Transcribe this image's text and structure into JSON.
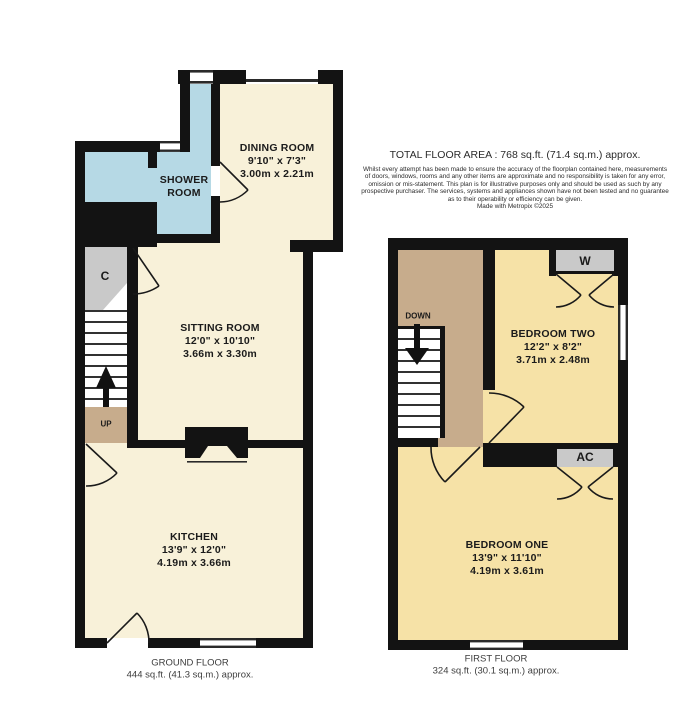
{
  "colors": {
    "wall": "#131313",
    "ground_room": "#f8f1d9",
    "first_room": "#f6e2a7",
    "landing": "#c7ac8c",
    "shower": "#b6d9e5",
    "cupboard": "#c9c9c9",
    "door_line": "#1a1a1a"
  },
  "header": {
    "total_area": "TOTAL FLOOR AREA : 768 sq.ft. (71.4 sq.m.) approx.",
    "disclaimer_lines": [
      "Whilst every attempt has been made to ensure the accuracy of the floorplan contained here, measurements",
      "of doors, windows, rooms and any other items are approximate and no responsibility is taken for any error,",
      "omission or mis-statement. This plan is for illustrative purposes only and should be used as such by any",
      "prospective purchaser. The services, systems and appliances shown have not been tested and no guarantee",
      "as to their operability or efficiency can be given."
    ],
    "made_with": "Made with Metropix ©2025"
  },
  "ground_floor": {
    "title": "GROUND FLOOR",
    "area": "444 sq.ft. (41.3 sq.m.) approx.",
    "rooms": {
      "dining": {
        "name": "DINING ROOM",
        "imperial": "9'10\" x 7'3\"",
        "metric": "3.00m x 2.21m"
      },
      "shower": {
        "line1": "SHOWER",
        "line2": "ROOM"
      },
      "sitting": {
        "name": "SITTING ROOM",
        "imperial": "12'0\" x 10'10\"",
        "metric": "3.66m x 3.30m"
      },
      "kitchen": {
        "name": "KITCHEN",
        "imperial": "13'9\" x 12'0\"",
        "metric": "4.19m x 3.66m"
      }
    },
    "annotations": {
      "cupboard": "C",
      "up": "UP"
    }
  },
  "first_floor": {
    "title": "FIRST FLOOR",
    "area": "324 sq.ft. (30.1 sq.m.) approx.",
    "rooms": {
      "bedroom_two": {
        "name": "BEDROOM TWO",
        "imperial": "12'2\" x 8'2\"",
        "metric": "3.71m x 2.48m"
      },
      "bedroom_one": {
        "name": "BEDROOM ONE",
        "imperial": "13'9\" x 11'10\"",
        "metric": "4.19m x 3.61m"
      }
    },
    "annotations": {
      "down": "DOWN",
      "wardrobe": "W",
      "airing_cupboard": "AC"
    }
  }
}
